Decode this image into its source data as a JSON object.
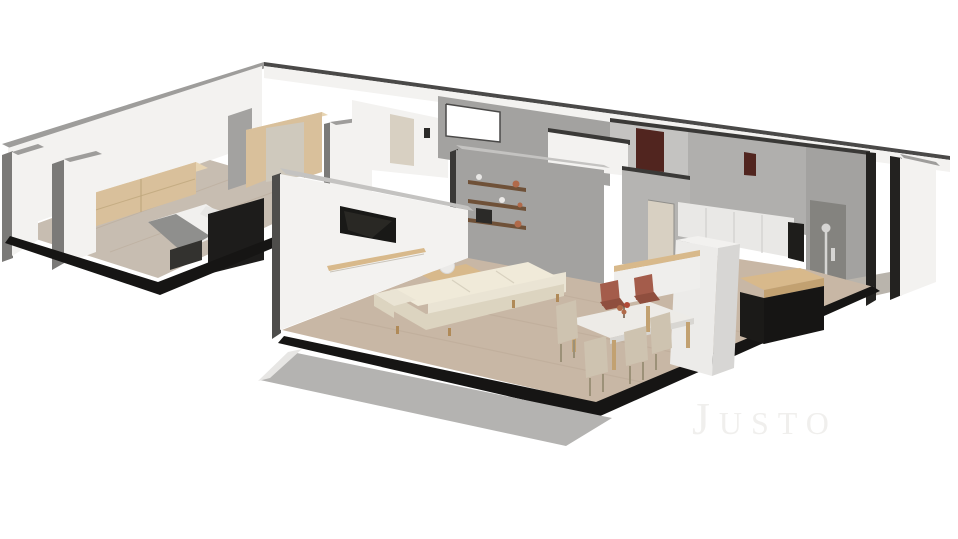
{
  "scene": {
    "watermark_text": "Justo"
  },
  "colors": {
    "background": "#ffffff",
    "wallWhite": "#f3f2f0",
    "wallWhiteShade": "#e6e5e3",
    "wallGrayTop": "#9e9d9b",
    "wallGrayLight": "#c4c3c1",
    "wallGrayMid": "#a3a2a0",
    "wallGrayDark": "#7b7a78",
    "wallCutDark": "#3a3937",
    "slabBlack": "#161514",
    "floorWoodCool": "#c7bdb1",
    "floorWoodWarm": "#c8b7a5",
    "floorPlank": "#b2a08c",
    "woodLight": "#d9c09b",
    "woodLightTop": "#e7d4b2",
    "woodMid": "#c2a171",
    "shelfWood": "#6f5138",
    "counterWood": "#d8b98b",
    "sofaCream": "#eae4d4",
    "sofaCreamShade": "#dcd4c0",
    "sofaCushion": "#f0ead9",
    "bedBlanket": "#8f8f8d",
    "bedSheet": "#f1f0ee",
    "furnitureBlack": "#1d1c1b",
    "tvBlack": "#191917",
    "tvGlare": "#36352f",
    "marbleTop": "#edebe7",
    "marbleEdge": "#d8d6d2",
    "chairRust": "#a45c4b",
    "chairRustDark": "#8f4e3e",
    "chairBeige": "#cec3b0",
    "doorMaroon": "#51251f",
    "doorTan": "#d8d0c2",
    "balconyGray": "#b4b3b1",
    "balconyEdge": "#e7e6e4",
    "metal": "#d6d5d3",
    "decorRust": "#b06a4a",
    "decorDark": "#2b2a28",
    "watermarkColor": "#f0efed"
  }
}
